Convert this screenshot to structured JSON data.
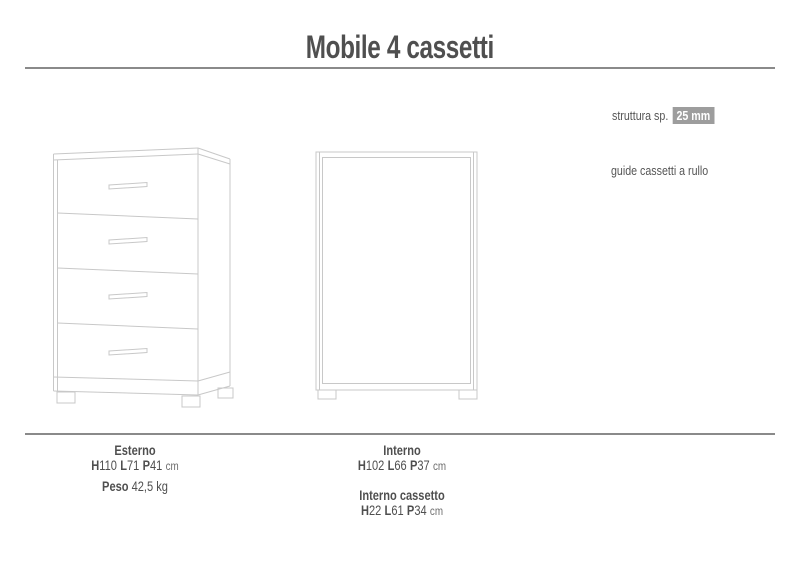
{
  "page": {
    "title": "Mobile 4 cassetti"
  },
  "annotations": {
    "struttura_label": "struttura sp.",
    "struttura_value": "25 mm",
    "guide_note": "guide cassetti a rullo"
  },
  "specs": {
    "esterno": {
      "title": "Esterno",
      "dims": [
        {
          "k": "H",
          "v": "110"
        },
        {
          "k": "L",
          "v": "71"
        },
        {
          "k": "P",
          "v": "41"
        }
      ],
      "unit": "cm",
      "peso_label": "Peso",
      "peso_value": "42,5 kg"
    },
    "interno": {
      "title": "Interno",
      "dims": [
        {
          "k": "H",
          "v": "102"
        },
        {
          "k": "L",
          "v": "66"
        },
        {
          "k": "P",
          "v": "37"
        }
      ],
      "unit": "cm"
    },
    "interno_cassetto": {
      "title": "Interno cassetto",
      "dims": [
        {
          "k": "H",
          "v": "22"
        },
        {
          "k": "L",
          "v": "61"
        },
        {
          "k": "P",
          "v": "34"
        }
      ],
      "unit": "cm"
    }
  },
  "drawings": {
    "front_view": "chest-of-drawers-4-drawers-three-quarter-line-drawing",
    "interior_view": "cabinet-carcass-front-line-drawing"
  },
  "colors": {
    "text": "#4f4f4f",
    "rule": "#8a8a8a",
    "badge_bg": "#9d9d9d",
    "badge_text": "#ffffff",
    "line_art": "#c8c8c8"
  }
}
